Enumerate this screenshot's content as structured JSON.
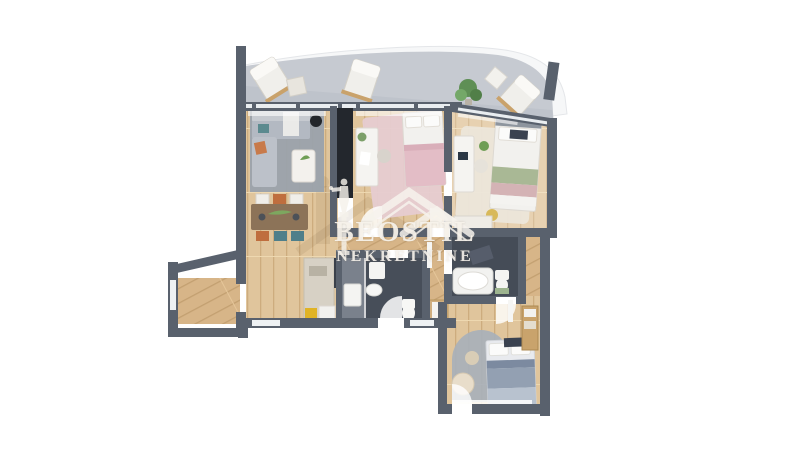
{
  "watermark": {
    "line1": "BEOSTIL",
    "line2": "NEKRETNINE",
    "logo": "victory-statue-and-roofs-logo"
  },
  "scene": {
    "type": "3d-apartment-floor-plan-render",
    "rooms": [
      "terrace",
      "living-room-with-dining",
      "bedroom-middle",
      "bedroom-right",
      "hallway",
      "bathroom-main",
      "bathroom-second",
      "bedroom-bottom",
      "balcony-niche"
    ]
  },
  "colors": {
    "background": "#ffffff",
    "wall": "#59616d",
    "wood_floor": "#dcbf95",
    "terrace_floor": "#c6cad1",
    "bathroom_tile": "#474e59",
    "rug_gray": "#9aa2ac",
    "rug_pink": "#e6ccd1",
    "rug_cream": "#ece6da",
    "accent_teal": "#4f7f8a",
    "accent_orange": "#bf6e3e",
    "plant_green": "#6f9e55",
    "watermark_text": "#f2ece3"
  }
}
